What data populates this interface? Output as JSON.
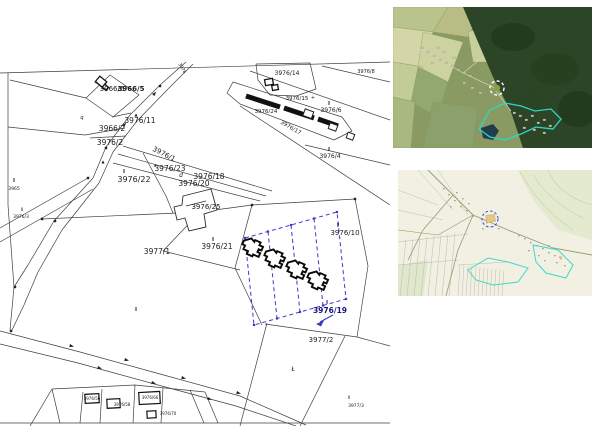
{
  "app": {
    "title": "Cadastral parcel map with location previews",
    "views": {
      "main_map": "cadastral-parcel-map",
      "top_right": "satellite-aerial-view",
      "mid_right": "topographic-map-view"
    }
  },
  "colors": {
    "map_line": "#3f3f3f",
    "label": "#1a1a1a",
    "navy": "#16167c",
    "selection_blue": "#3a3ac8",
    "teal_outline": "#2fd6c3",
    "topo_marker_blue": "#3b55cc",
    "topo_marker_fill": "#e7c684",
    "forest_green": "#2c4526",
    "field_green": "#c2cc96"
  },
  "icons": {
    "satellite_marker": "dashed-circle-icon",
    "topo_marker": "dashed-circle-icon",
    "selection_pointer": "arrow-icon"
  },
  "map": {
    "selected_parcel": "3976/19",
    "selection_lot_count": 4,
    "labels": [
      {
        "t": "3966/6",
        "x": 112,
        "y": 91,
        "s": 7
      },
      {
        "t": "3966/5",
        "x": 131,
        "y": 91,
        "s": 7,
        "b": 1
      },
      {
        "t": "3976/11",
        "x": 140,
        "y": 123,
        "s": 7.5
      },
      {
        "t": "3966/2",
        "x": 112,
        "y": 131,
        "s": 7.5
      },
      {
        "t": "3976/2",
        "x": 110,
        "y": 145,
        "s": 7.5
      },
      {
        "t": "3976/1",
        "x": 163,
        "y": 156,
        "s": 7,
        "r": 27
      },
      {
        "t": "3976/23",
        "x": 170,
        "y": 171,
        "s": 7.5
      },
      {
        "t": "II",
        "x": 124,
        "y": 173,
        "s": 5
      },
      {
        "t": "3976/22",
        "x": 134,
        "y": 182,
        "s": 8
      },
      {
        "t": "d",
        "x": 181,
        "y": 177,
        "s": 6,
        "i": 1
      },
      {
        "t": "3976/18",
        "x": 209,
        "y": 179,
        "s": 7.5
      },
      {
        "t": "3976/20",
        "x": 194,
        "y": 186,
        "s": 7.5
      },
      {
        "t": "3976/25",
        "x": 206,
        "y": 209,
        "s": 7
      },
      {
        "t": "II",
        "x": 213,
        "y": 241,
        "s": 5
      },
      {
        "t": "3976/21",
        "x": 217,
        "y": 249,
        "s": 7.5
      },
      {
        "t": "3977/1",
        "x": 157,
        "y": 254,
        "s": 7.5
      },
      {
        "t": "II",
        "x": 338,
        "y": 227,
        "s": 5
      },
      {
        "t": "3976/10",
        "x": 345,
        "y": 235,
        "s": 7
      },
      {
        "t": "II",
        "x": 327,
        "y": 304,
        "s": 5,
        "c": "navy"
      },
      {
        "t": "3976/19",
        "x": 330,
        "y": 313,
        "s": 7.5,
        "b": 1,
        "c": "navy"
      },
      {
        "t": "3977/2",
        "x": 321,
        "y": 342,
        "s": 7
      },
      {
        "t": "II",
        "x": 349,
        "y": 399,
        "s": 4.5
      },
      {
        "t": "3977/3",
        "x": 356,
        "y": 407,
        "s": 4.5
      },
      {
        "t": "3976/14",
        "x": 287,
        "y": 75,
        "s": 6
      },
      {
        "t": "3976/8",
        "x": 366,
        "y": 73,
        "s": 5
      },
      {
        "t": "3976/15",
        "x": 297,
        "y": 100,
        "s": 5.5
      },
      {
        "t": "3976/24",
        "x": 266,
        "y": 113,
        "s": 5.5
      },
      {
        "t": "3976/17",
        "x": 290,
        "y": 129,
        "s": 5.5,
        "r": 30
      },
      {
        "t": "II",
        "x": 329,
        "y": 105,
        "s": 5
      },
      {
        "t": "3976/6",
        "x": 331,
        "y": 112,
        "s": 6
      },
      {
        "t": "II",
        "x": 329,
        "y": 151,
        "s": 5
      },
      {
        "t": "3976/4",
        "x": 330,
        "y": 158,
        "s": 6
      },
      {
        "t": "II",
        "x": 14,
        "y": 182,
        "s": 5
      },
      {
        "t": "3965",
        "x": 14,
        "y": 190,
        "s": 4.5
      },
      {
        "t": "II",
        "x": 22,
        "y": 211,
        "s": 4.5
      },
      {
        "t": "3976/3",
        "x": 21,
        "y": 218,
        "s": 4.5
      },
      {
        "t": "II",
        "x": 136,
        "y": 311,
        "s": 5
      },
      {
        "t": "3976/56",
        "x": 92,
        "y": 400,
        "s": 4
      },
      {
        "t": "3976/58",
        "x": 122,
        "y": 406,
        "s": 4
      },
      {
        "t": "3976/66",
        "x": 150,
        "y": 399,
        "s": 4
      },
      {
        "t": "3976/70",
        "x": 168,
        "y": 415,
        "s": 4
      },
      {
        "t": "Ł",
        "x": 293,
        "y": 371,
        "s": 6
      },
      {
        "t": "3976",
        "x": 181,
        "y": 69,
        "s": 4.5,
        "r": 60
      },
      {
        "t": "q",
        "x": 82,
        "y": 119,
        "s": 5,
        "i": 1
      },
      {
        "t": "a",
        "x": 155,
        "y": 167,
        "s": 5,
        "i": 1
      },
      {
        "t": "+",
        "x": 313,
        "y": 99,
        "s": 5
      },
      {
        "t": "+",
        "x": 96,
        "y": 84,
        "s": 5
      },
      {
        "t": "▲",
        "x": 136,
        "y": 116,
        "s": 4
      },
      {
        "t": "▲",
        "x": 103,
        "y": 163,
        "s": 4
      }
    ]
  }
}
